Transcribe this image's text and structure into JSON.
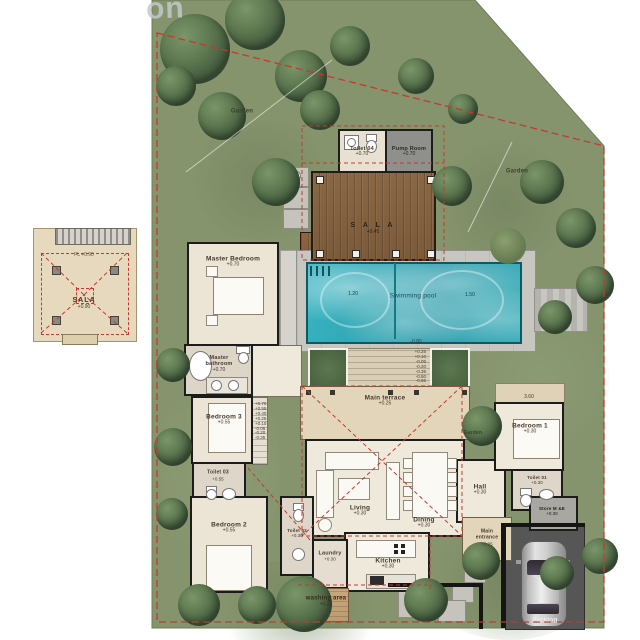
{
  "watermark": "on",
  "garden": {
    "label": "Garden"
  },
  "outbuilding": {
    "toilet": {
      "name": "Toilet 04",
      "elev": "+0.70"
    },
    "pump": {
      "name": "Pump Room",
      "elev": "+0.70"
    }
  },
  "sala_deck": {
    "name": "S A L A",
    "elev": "+0.45"
  },
  "pool": {
    "name": "Swimming pool",
    "depth_left": "1.20",
    "depth_right": "1.50",
    "deck_level": "-0.80"
  },
  "rooms": {
    "master_bedroom": {
      "name": "Master Bedroom",
      "elev": "+0.70"
    },
    "master_bathroom": {
      "name": "Master bathroom",
      "elev": "+0.70"
    },
    "bedroom3": {
      "name": "Bedroom 3",
      "elev": "+0.55"
    },
    "toilet03": {
      "name": "Toilet 03",
      "elev": "+0.55"
    },
    "bedroom2": {
      "name": "Bedroom 2",
      "elev": "+0.55"
    },
    "toilet02": {
      "name": "Toilet 02",
      "elev": "+0.30"
    },
    "living": {
      "name": "Living",
      "elev": "+0.30"
    },
    "dining": {
      "name": "Dining",
      "elev": "+0.30"
    },
    "kitchen": {
      "name": "Kitchen",
      "elev": "+0.30"
    },
    "laundry": {
      "name": "Laundry",
      "elev": "+0.30"
    },
    "washing_area": {
      "name": "washing area",
      "elev": "+0.25"
    },
    "main_terrace": {
      "name": "Main terrace",
      "elev": "+0.25"
    },
    "hall": {
      "name": "Hall",
      "elev": "+0.30"
    },
    "main_entrance": {
      "name": "Main entrance",
      "elev": "+0.25"
    },
    "bedroom1": {
      "name": "Bedroom 1",
      "elev": "+0.30"
    },
    "toilet01": {
      "name": "Toilet 01",
      "elev": "+0.30"
    },
    "store": {
      "name": "Store M &E",
      "elev": "+0.30"
    }
  },
  "parking": {
    "name": "Parking"
  },
  "pavilion": {
    "fl": "FL +0.90",
    "name": "SALA",
    "elev": "+0.90"
  },
  "dimensions": {
    "bedroom1_width": "3.60"
  },
  "steps": {
    "terrace_stack": [
      "+0.25",
      "+0.10",
      "-0.05",
      "-0.20",
      "-0.35",
      "-0.50",
      "-0.65"
    ],
    "garden_path_stack": [
      "+0.70",
      "+0.55",
      "+0.40",
      "+0.25",
      "+0.10",
      "-0.05",
      "-0.20",
      "-0.35"
    ]
  },
  "colors": {
    "grass": "#85946d",
    "pool_water": "#2ea8b5",
    "boundary_red": "#c23b2e",
    "deck_wood": "#82603f",
    "parking_grey": "#565656"
  }
}
